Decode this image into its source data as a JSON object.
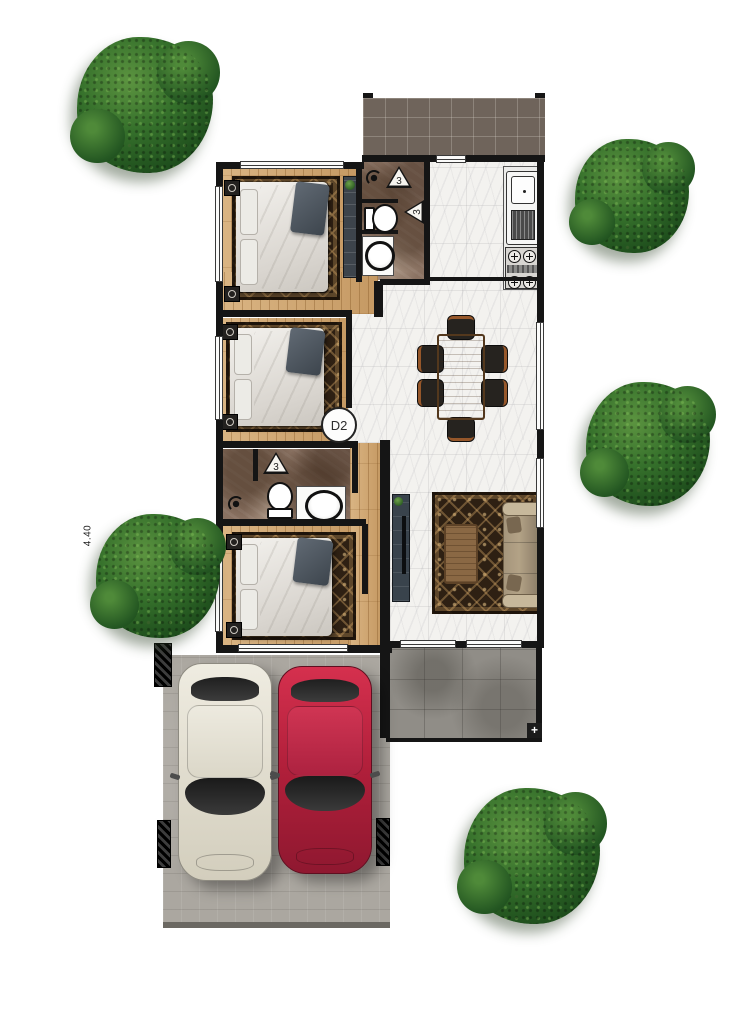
{
  "labels": {
    "dimension_440": "4.40",
    "door_tag_d2": "D2",
    "bath1_marker_upper": "3",
    "bath1_marker_lower": "3",
    "bath2_marker": "3",
    "terrace_corner_marker": "+"
  },
  "palette": {
    "wall": "#151515",
    "wood": "#cda26c",
    "marble": "#f3f2ef",
    "bath_marble": "#8a7262",
    "rug": "#2e2013",
    "porch_tile": "#6f645b",
    "terrace": "#908d87",
    "carport": "#aba7a0",
    "tree_green": "#2d6327",
    "car_red": "#c41f3e",
    "car_white": "#e4e0d3",
    "sofa": "#b3a286",
    "table_wood": "#96673d"
  }
}
